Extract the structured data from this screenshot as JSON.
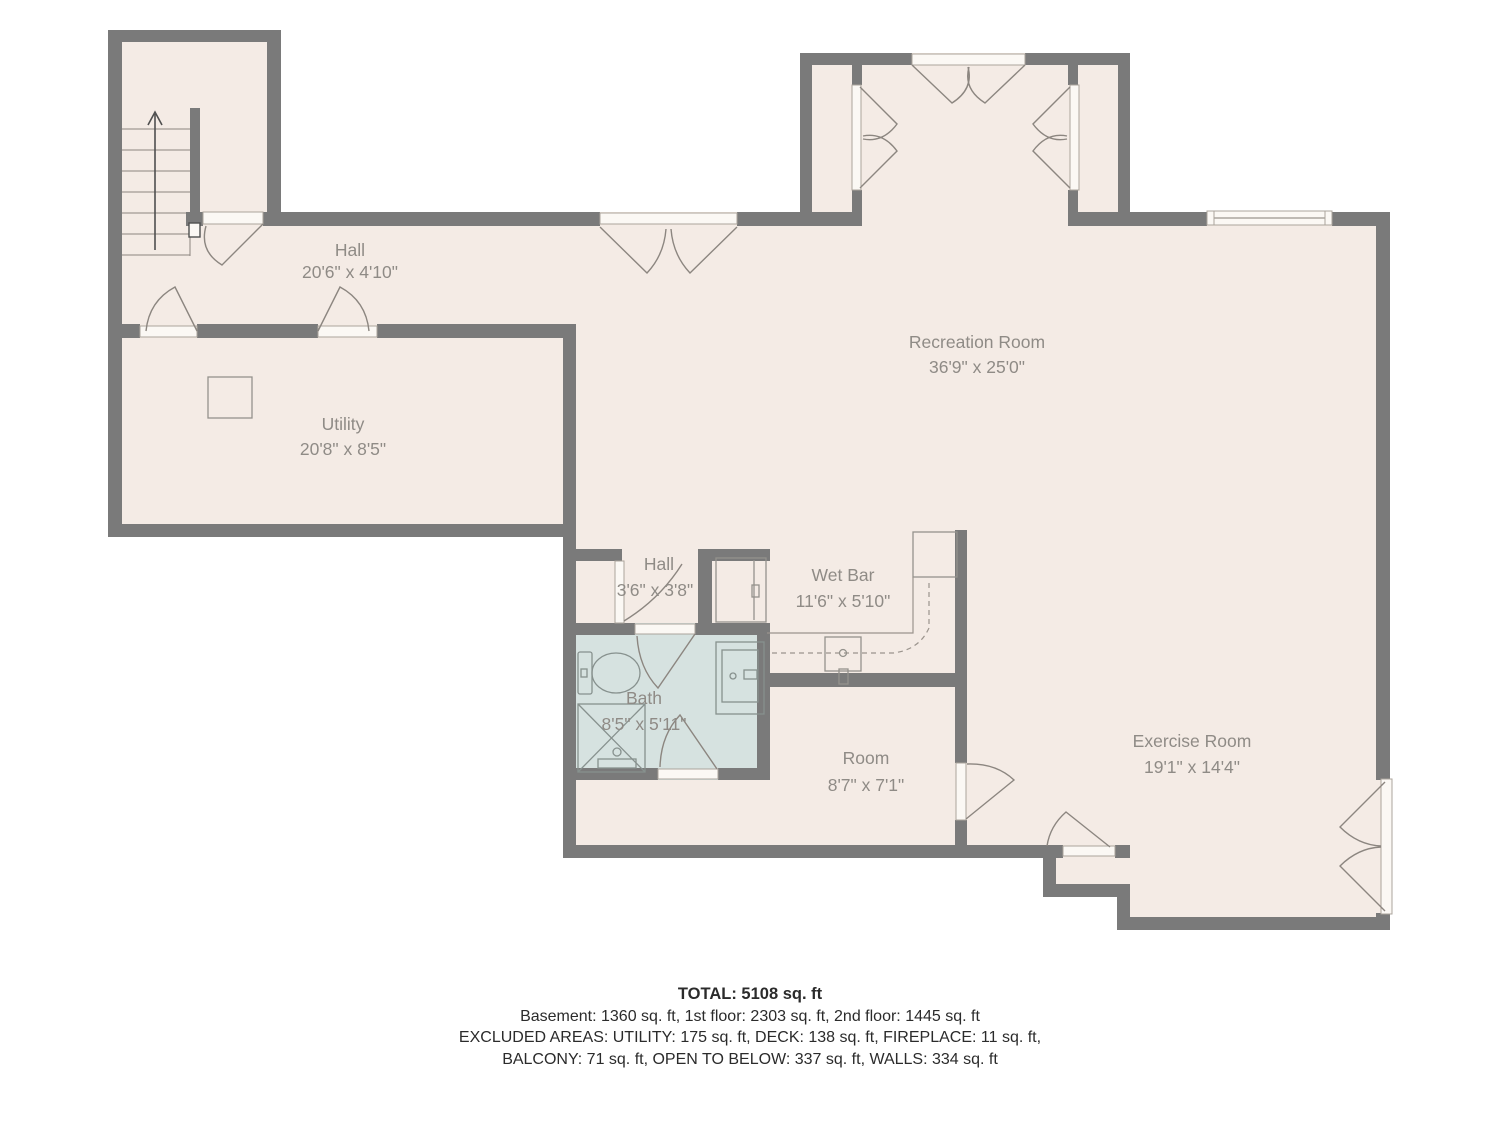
{
  "plan": {
    "type": "floor-plan",
    "rooms": [
      {
        "id": "hall-upper",
        "name": "Hall",
        "dims": "20'6\" x 4'10\""
      },
      {
        "id": "utility",
        "name": "Utility",
        "dims": "20'8\" x 8'5\""
      },
      {
        "id": "recreation",
        "name": "Recreation Room",
        "dims": "36'9\" x 25'0\""
      },
      {
        "id": "hall-lower",
        "name": "Hall",
        "dims": "3'6\" x 3'8\""
      },
      {
        "id": "wet-bar",
        "name": "Wet Bar",
        "dims": "11'6\" x 5'10\""
      },
      {
        "id": "bath",
        "name": "Bath",
        "dims": "8'5\" x 5'11\""
      },
      {
        "id": "room",
        "name": "Room",
        "dims": "8'7\" x 7'1\""
      },
      {
        "id": "exercise",
        "name": "Exercise Room",
        "dims": "19'1\" x 14'4\""
      }
    ],
    "fixtures": [
      "staircase-up-arrow",
      "furnace-square",
      "toilet",
      "shower",
      "vanity-sink",
      "wet-bar-counter",
      "wet-bar-sink",
      "wet-bar-cabinets",
      "window",
      "french-doors"
    ],
    "footer": {
      "total": "TOTAL: 5108 sq. ft",
      "line1": "Basement: 1360 sq. ft, 1st floor: 2303 sq. ft, 2nd floor: 1445 sq. ft",
      "line2": "EXCLUDED AREAS: UTILITY: 175 sq. ft, DECK: 138 sq. ft, FIREPLACE: 11 sq. ft,",
      "line3": "BALCONY: 71 sq. ft, OPEN TO BELOW: 337 sq. ft, WALLS: 334 sq. ft"
    },
    "colors": {
      "wall": "#7a7a7a",
      "floor": "#f4ebe5",
      "bath_floor": "#d6e2e0",
      "line": "#8c8680",
      "label_text": "#8f8b86",
      "footer_text": "#2b2b2b"
    }
  }
}
